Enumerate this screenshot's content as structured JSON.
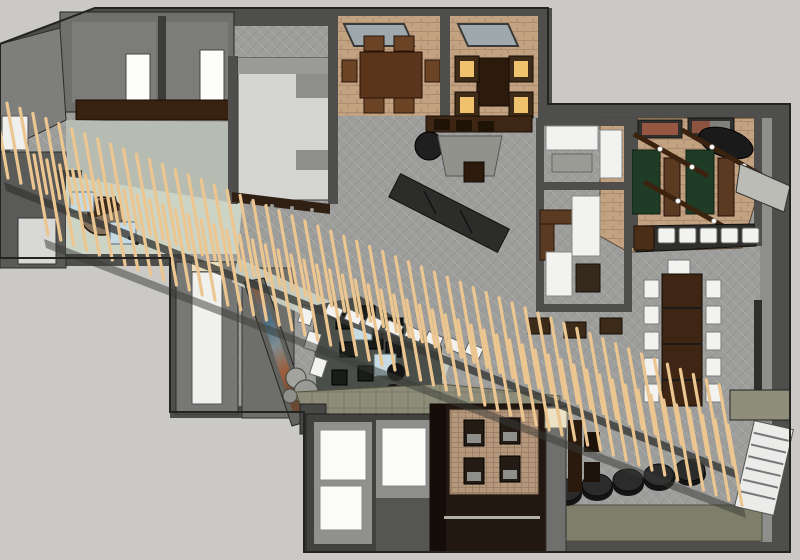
{
  "meta": {
    "title": "3D rendered interior floor plan, top-down axonometric view",
    "description": "SketchUp-style overhead rendering of a hospitality interior: dining rooms with skylights, games room with green tables and ceiling beams, long communal table, lounge with art wall and rock feature, reception desk, restrooms, and a diagonal timber-slat screen crossing the whole plan"
  },
  "palette": {
    "outside": "#cac9c5",
    "wall": "#4e4e4c",
    "wall_light": "#7b7b79",
    "floor_carpet": "#9d9d9b",
    "floor_tan": "#c3a282",
    "floor_pale_tile": "#b6bcb2",
    "floor_pale_green": "#ccd4c6",
    "floor_lounge_dark": "#4a4e49",
    "floor_espresso": "#231811",
    "floor_khaki": "#8d8c78",
    "floor_white": "#f0f0ee",
    "wood_dark": "#3f2513",
    "wood_mid": "#5b3a22",
    "slat": "#ecc690",
    "green_table": "#1f3d26",
    "amber_seat": "#f0c26d",
    "blue_seat": "#c6dae4",
    "white_furniture": "#f2f2f0",
    "black_furniture": "#1f1f1f",
    "olive_band": "#7f7e6b"
  },
  "slat_screen": {
    "rows": [
      {
        "count": 57,
        "origin_x": 8,
        "origin_y": 178,
        "step_x": 12.95,
        "step_y": 5.12
      },
      {
        "count": 55,
        "origin_x": 48,
        "origin_y": 235,
        "step_x": 12.85,
        "step_y": 5.0
      }
    ],
    "slant_dx": -14,
    "slant_dy": -80,
    "stroke_width": 3.2
  },
  "scene": {
    "dining_room_chairs": 6,
    "booth_room_lit_seats": 4,
    "skylights": 2,
    "games_room_green_tables": 2,
    "games_room_ceiling_beams": 3,
    "wall_pictures": 2,
    "bar_white_stools": 5,
    "communal_table_side_chairs": 10,
    "communal_table_head_chairs": 1,
    "lounge_black_chairs": 8,
    "lounge_blue_tables": 2,
    "lounge_black_poufs": 2,
    "cylinder_stools": 5,
    "espresso_room_chairs": 4,
    "reception_blue_seats": 2,
    "slat_bench_seats": 8,
    "counter_stools_top_left": 3,
    "office_stools": 3
  }
}
